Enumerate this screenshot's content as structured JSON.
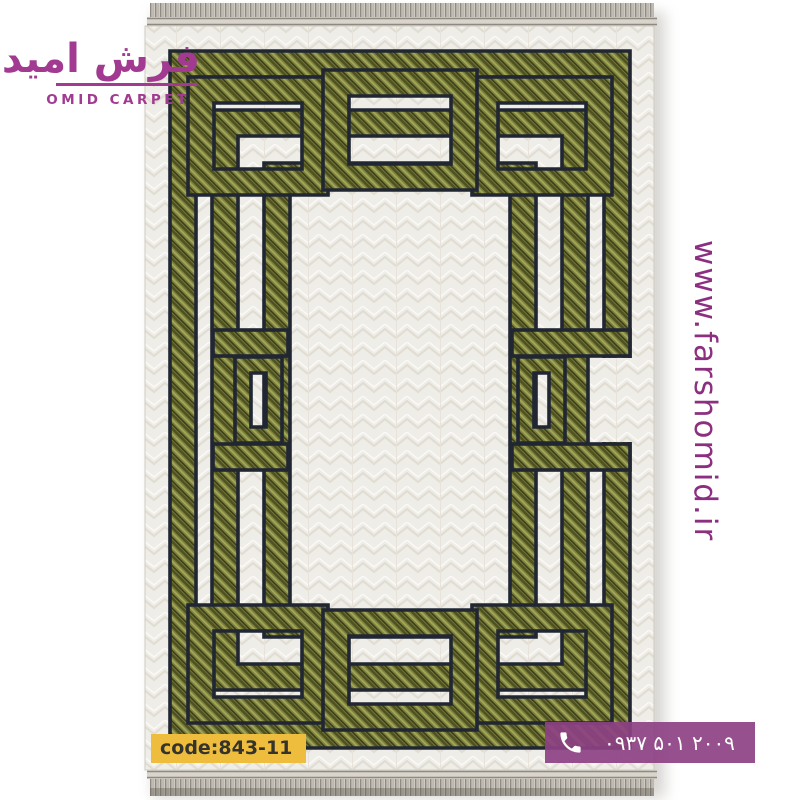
{
  "brand": {
    "logo_fa": "فرش امید",
    "logo_en": "OMID CARPET",
    "website": "www.farshomid.ir"
  },
  "product": {
    "code_label": "code:843-11"
  },
  "contact": {
    "phone_number": "۰۹۳۷ ۵۰۱ ۲۰۰۹",
    "phone_icon": "phone-handset-icon"
  },
  "colors": {
    "brand_purple": "#a13a90",
    "url_purple": "#8c2f80",
    "phone_bar_purple": "#8d4183",
    "code_badge_yellow": "#eebd3e",
    "code_text": "#35342c",
    "band_green": "#7d8040",
    "band_outline": "#212633",
    "carpet_cream": "#efede8",
    "fringe_gray": "#8f8b82"
  }
}
